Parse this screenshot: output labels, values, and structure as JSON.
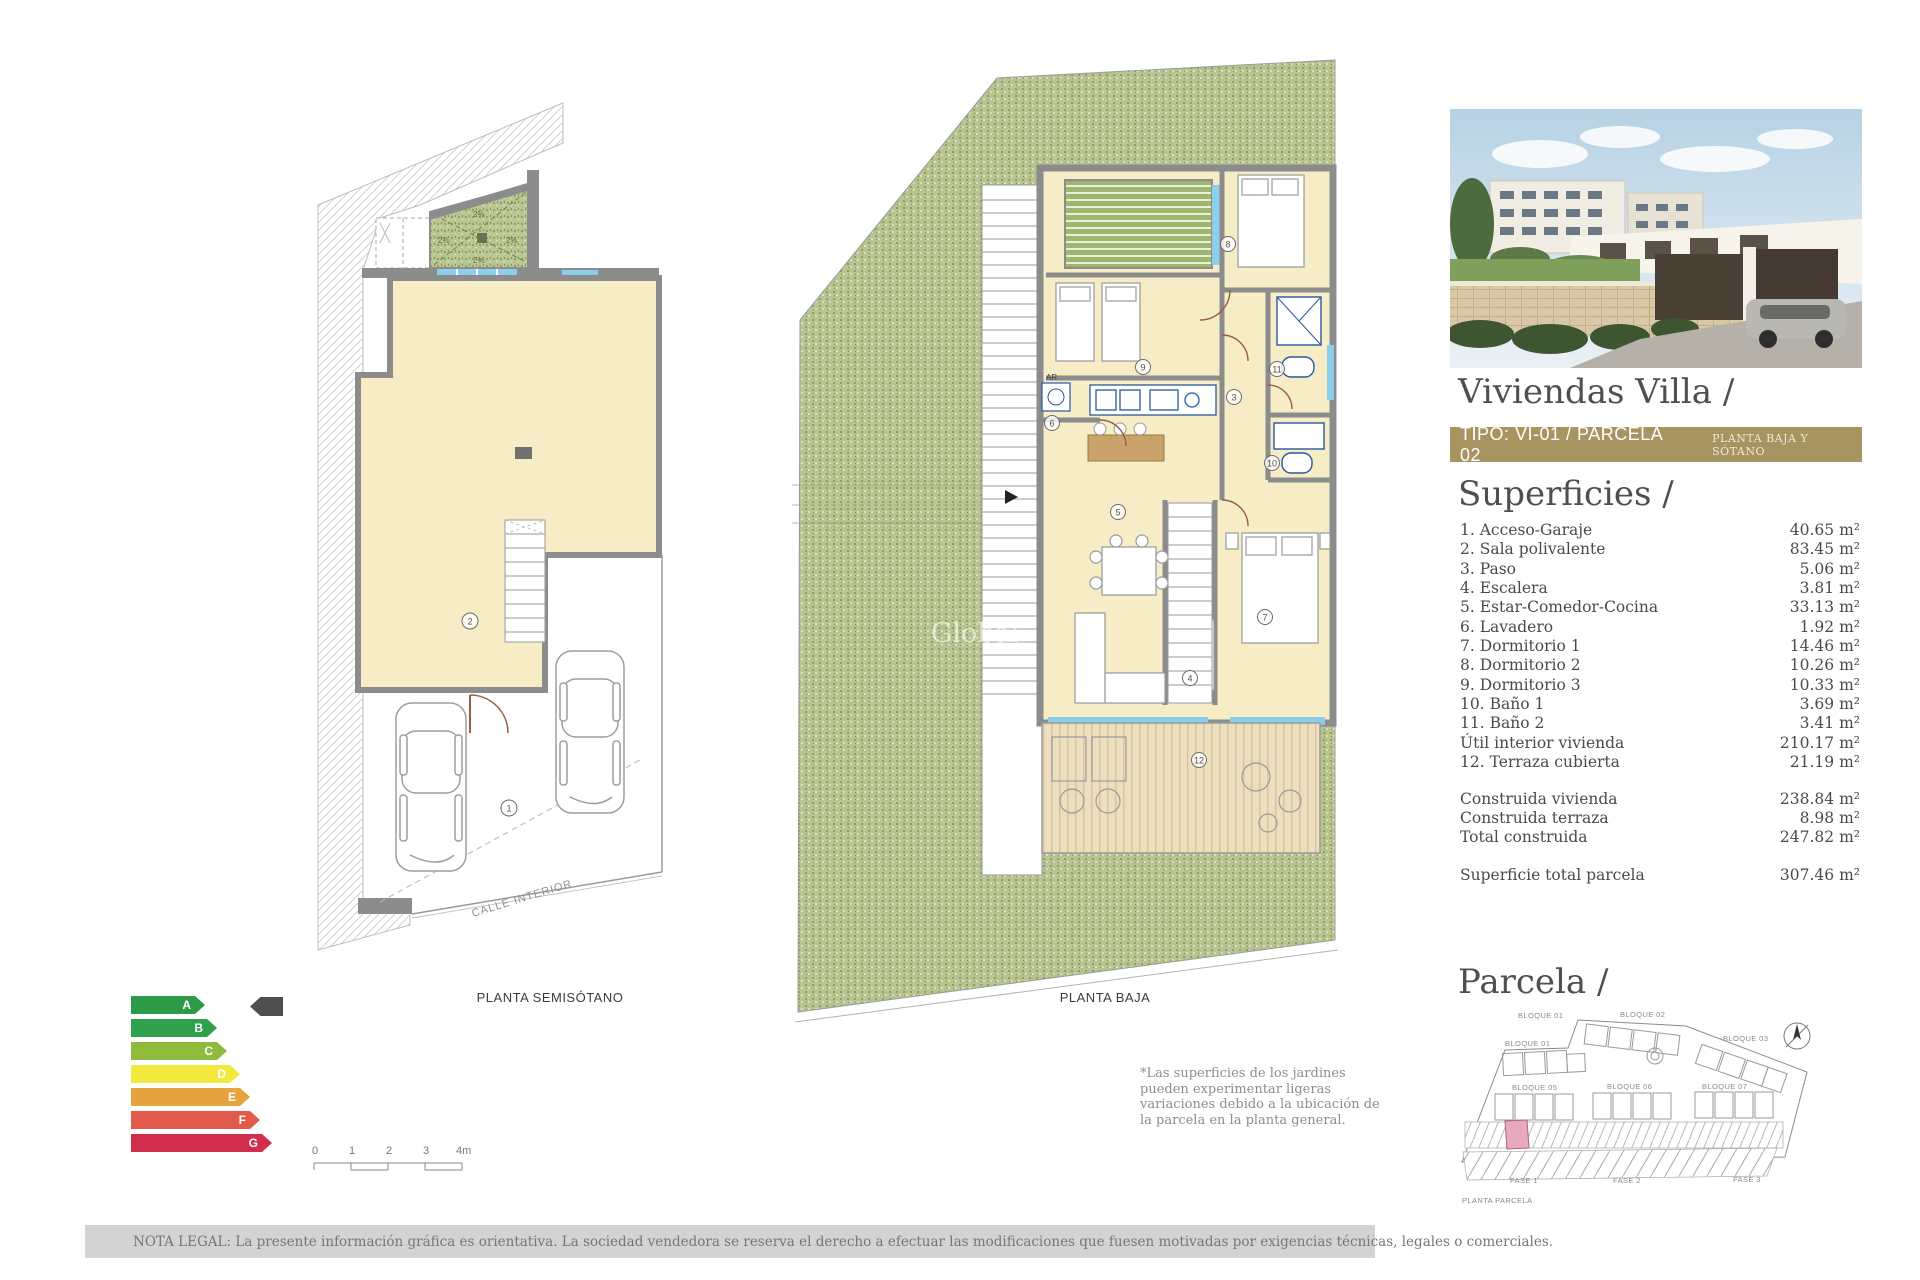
{
  "panel": {
    "title": "Viviendas Villa /",
    "type_banner": {
      "left": "TIPO: VI-01 / PARCELA 02",
      "right": "PLANTA BAJA Y SÓTANO",
      "bg": "#a79460"
    },
    "superficies": {
      "heading": "Superficies /",
      "rows": [
        {
          "label": "1. Acceso-Garaje",
          "value": "40.65 m²"
        },
        {
          "label": "2. Sala polivalente",
          "value": "83.45 m²"
        },
        {
          "label": "3. Paso",
          "value": "5.06 m²"
        },
        {
          "label": "4. Escalera",
          "value": "3.81 m²"
        },
        {
          "label": "5. Estar-Comedor-Cocina",
          "value": "33.13 m²"
        },
        {
          "label": "6. Lavadero",
          "value": "1.92 m²"
        },
        {
          "label": "7. Dormitorio 1",
          "value": "14.46 m²"
        },
        {
          "label": "8. Dormitorio 2",
          "value": "10.26 m²"
        },
        {
          "label": "9. Dormitorio 3",
          "value": "10.33 m²"
        },
        {
          "label": "10. Baño 1",
          "value": "3.69 m²"
        },
        {
          "label": "11. Baño 2",
          "value": "3.41 m²"
        },
        {
          "label": "Útil interior vivienda",
          "value": "210.17 m²"
        },
        {
          "label": "12. Terraza cubierta",
          "value": "21.19 m²"
        }
      ],
      "totals": [
        {
          "label": "Construida vivienda",
          "value": "238.84 m²"
        },
        {
          "label": "Construida terraza",
          "value": "8.98 m²"
        },
        {
          "label": "Total construida",
          "value": "247.82 m²"
        }
      ],
      "parcel_total": {
        "label": "Superficie total parcela",
        "value": "307.46 m²"
      }
    },
    "parcela": {
      "heading": "Parcela /",
      "caption": "PLANTA PARCELA",
      "bloques": [
        "BLOQUE 01",
        "BLOQUE 02",
        "BLOQUE 03",
        "BLOQUE 01",
        "BLOQUE 05",
        "BLOQUE 06",
        "BLOQUE 07"
      ],
      "fases": [
        "FASE 1",
        "FASE 2",
        "FASE 3"
      ],
      "highlight_color": "#e8a9bd"
    }
  },
  "plans": {
    "semisotano": {
      "label": "PLANTA SEMISÓTANO",
      "street": "CALLE INTERIOR",
      "slopes": [
        "2%",
        "2%",
        "2%",
        "2%"
      ],
      "rooms": [
        "1",
        "2"
      ]
    },
    "baja": {
      "label": "PLANTA BAJA",
      "rooms": [
        "8",
        "9",
        "11",
        "3",
        "6",
        "10",
        "5",
        "7",
        "4",
        "12"
      ],
      "closet": "AR",
      "watermark": "Global"
    }
  },
  "energy": {
    "pointer_row": "A",
    "pointer_color": "#4f4f4f",
    "ratings": [
      {
        "letter": "A",
        "color": "#2d9a47"
      },
      {
        "letter": "B",
        "color": "#2fa04c"
      },
      {
        "letter": "C",
        "color": "#8ebb3c"
      },
      {
        "letter": "D",
        "color": "#f2e93d"
      },
      {
        "letter": "E",
        "color": "#e7a43e"
      },
      {
        "letter": "F",
        "color": "#e15a4a"
      },
      {
        "letter": "G",
        "color": "#d12d4d"
      }
    ]
  },
  "scalebar": {
    "ticks": [
      "0",
      "1",
      "2",
      "3",
      "4m"
    ]
  },
  "notes": {
    "garden": "*Las superficies de los jardines pueden experimentar ligeras variaciones debido a la ubicación de la parcela en la planta general.",
    "legal": "NOTA LEGAL: La presente información gráfica es orientativa. La sociedad vendedora se reserva el derecho a efectuar las modificaciones que fuesen motivadas por exigencias técnicas, legales o comerciales."
  }
}
